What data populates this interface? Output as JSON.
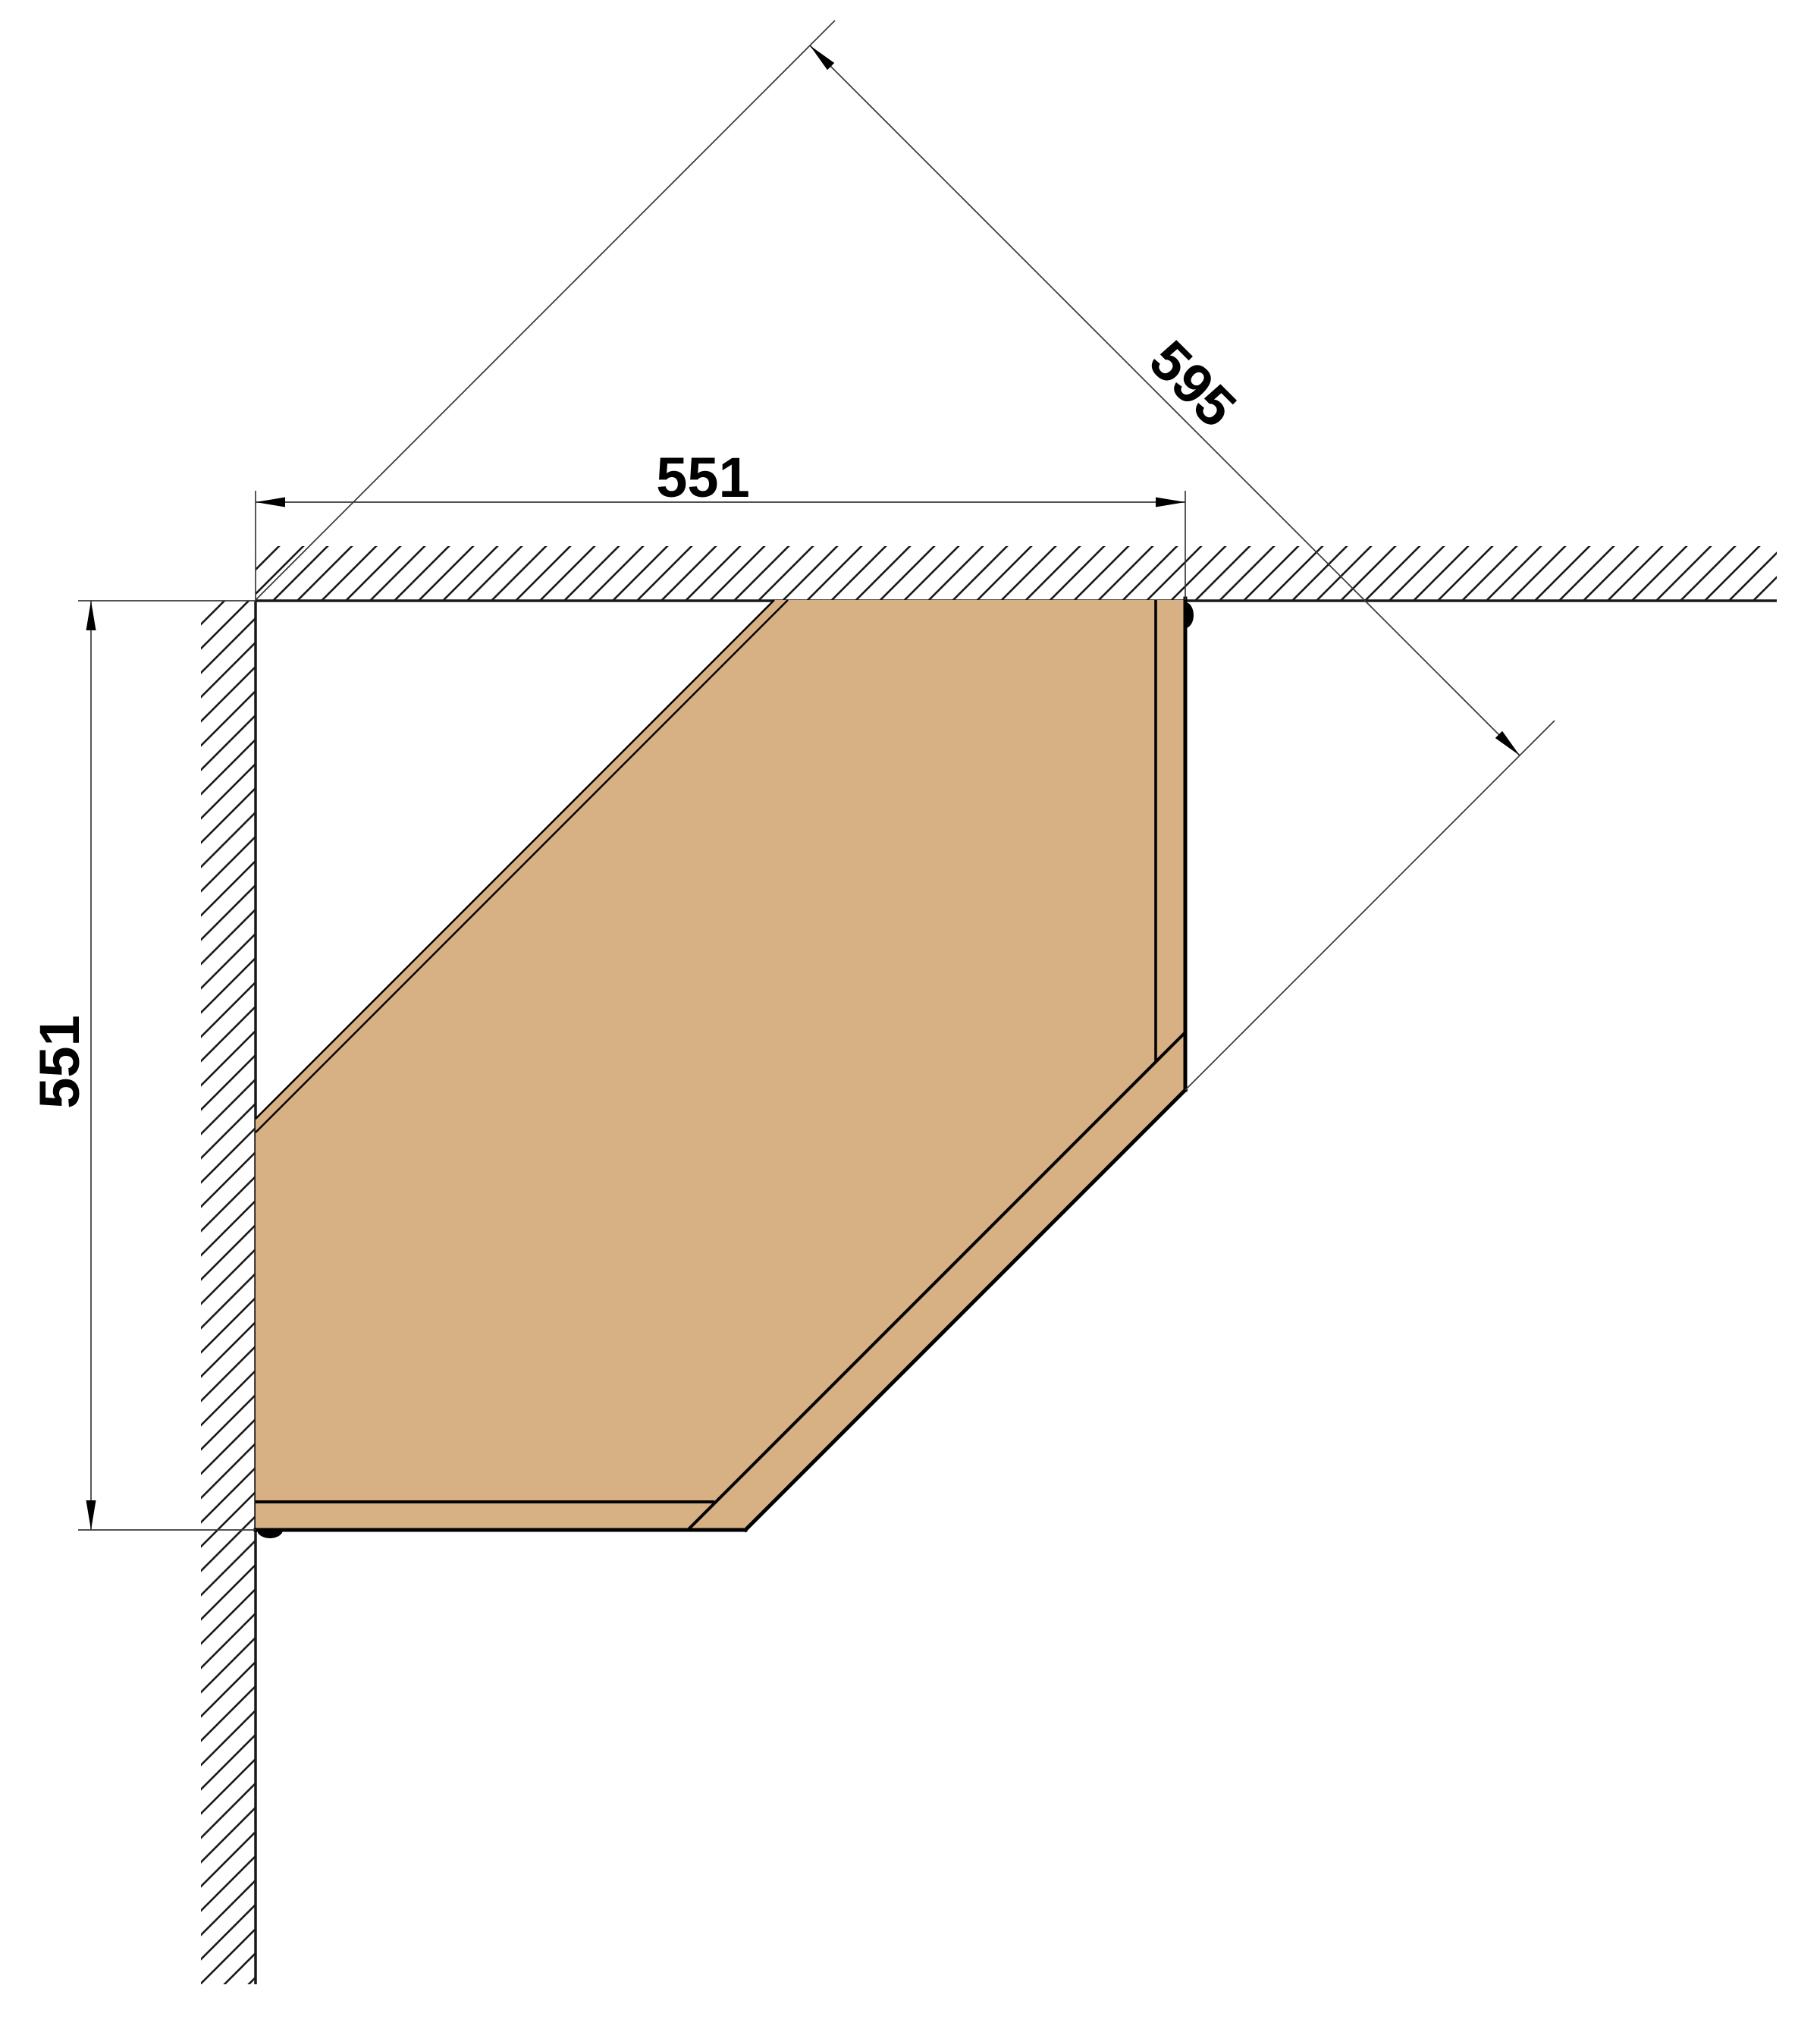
{
  "drawing": {
    "kind": "plan-view technical drawing of a diagonal corner cabinet mounted between two hatched walls",
    "dimensions": {
      "top_width_label": "551",
      "left_depth_label": "551",
      "diagonal_label": "595"
    },
    "colors": {
      "background": "#ffffff",
      "cabinet_fill": "#d7b084",
      "cabinet_outline": "#000000",
      "wall_line": "#1a1a1a",
      "dimension_line": "#3a3a3a",
      "text": "#000000"
    }
  }
}
